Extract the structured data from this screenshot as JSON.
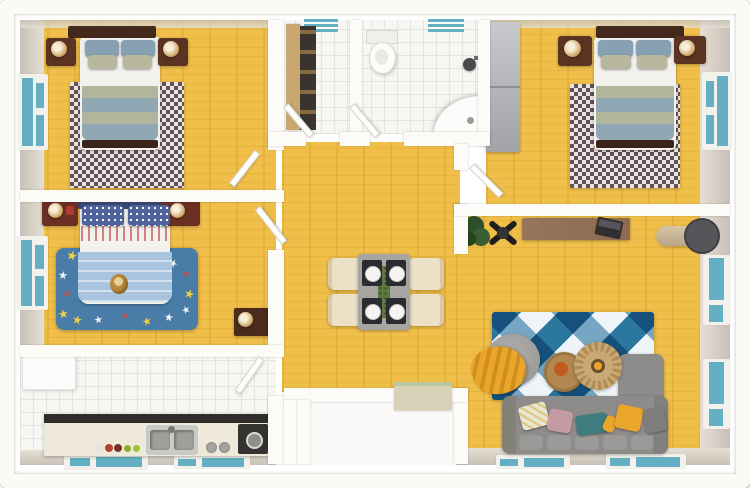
{
  "scene": {
    "type": "3d-floor-plan-render",
    "view": "top-down dollhouse",
    "text_visible": false
  },
  "palette": {
    "page_bg": "#ffffff",
    "outer_wall": "#fbfaf7",
    "wall": "#fcfbf8",
    "wall_face_light": "#e6dfd4",
    "wall_face_dark": "#c8c1b6",
    "wood": "#f0bf4a",
    "tile": "#f6f6f3",
    "tile_line": "#e3e3df",
    "window_teal": "#64afc3",
    "rug_checker_dark": "#63505a",
    "rug_checker_light": "#eae4de",
    "kids_rug": "#4a7ca8",
    "star_white": "#f2f4f6",
    "star_yellow": "#ecd04c",
    "star_red": "#cb4646",
    "argyle_white": "#eff4f8",
    "argyle_mid": "#7fadc7",
    "argyle_dark": "#2e7ca3",
    "sofa": "#8e8c8a",
    "sofa_seg": "#9c9a98",
    "pillow_teal": "#3f7d80",
    "pillow_mauve": "#c49aa4",
    "pillow_gray": "#7f7d7b",
    "accent_yellow": "#eaa62a",
    "headboard": "#44281c",
    "bed_white": "#f3f1ec",
    "blanket_sage": "#b0b59b",
    "blanket_blue": "#90a8b3",
    "pillow_slate": "#87a0b2",
    "pillow_sage": "#b7b89e",
    "nightstand": "#5a3322",
    "kids_nightstand": "#6b2f23",
    "kids_headboard": "#39486e",
    "kids_pillow": "#4e639b",
    "kids_blanket": "#a9c4de",
    "wardrobe_light": "#c9c9cd",
    "wardrobe_dark": "#a2a3a7",
    "desk": "#8d6b4f",
    "table_gray": "#a7a5a2",
    "chair_cream": "#ece1c6",
    "counter": "#efe9da",
    "counter_edge": "#2e2d2b",
    "steel": "#c9c9c6",
    "steel_dark": "#9e9e9a",
    "stove": "#35332f",
    "fridge": "#fbfbfa",
    "runner_green": "#5c7a40",
    "mat": "#d9d0b8",
    "mat_edge": "#bcc9a0",
    "pouf": "#9c9a96",
    "tan_table": "#c9a873",
    "tan_table_dark": "#b08b55",
    "wood_table": "#b28750",
    "bowl_orange": "#c05a1e",
    "plant": "#2e4d2a",
    "lamp_head": "#55565a",
    "lamp_body": "#d6c4a4",
    "gold": "#c9a05a"
  },
  "rooms": [
    {
      "id": "bedroom-top-left",
      "furniture": [
        "double-bed",
        "nightstand",
        "nightstand",
        "table-lamps",
        "checkered-rug",
        "window"
      ]
    },
    {
      "id": "utility-closet",
      "furniture": [
        "shelving-unit",
        "vent-window"
      ]
    },
    {
      "id": "bathroom",
      "furniture": [
        "toilet",
        "corner-sink",
        "shower-head",
        "vent-window"
      ]
    },
    {
      "id": "bedroom-top-right",
      "furniture": [
        "double-bed",
        "nightstand",
        "nightstand",
        "table-lamps",
        "checkered-rug",
        "wardrobe",
        "window"
      ]
    },
    {
      "id": "kids-bedroom",
      "furniture": [
        "kids-bed",
        "teddy-bear",
        "star-rug",
        "nightstand",
        "nightstand",
        "dresser",
        "window"
      ]
    },
    {
      "id": "kitchen",
      "furniture": [
        "fridge",
        "counter",
        "double-sink",
        "stove",
        "jars",
        "bottom-windows"
      ]
    },
    {
      "id": "dining-hall",
      "furniture": [
        "dining-table",
        "four-chairs",
        "four-place-settings",
        "green-runner",
        "doormat"
      ]
    },
    {
      "id": "living-room",
      "furniture": [
        "desk",
        "office-chair",
        "laptop",
        "potted-plant",
        "floor-lamp",
        "argyle-rug",
        "round-pouf",
        "yellow-throw",
        "coffee-table",
        "fringe-side-table",
        "sectional-sofa",
        "throw-pillows",
        "windows"
      ]
    },
    {
      "id": "entry-porch",
      "furniture": []
    }
  ],
  "counts": {
    "rooms": 9,
    "teal_windows": 11,
    "dining_chairs": 4,
    "sofa_pillows": 6,
    "beds": 3
  }
}
